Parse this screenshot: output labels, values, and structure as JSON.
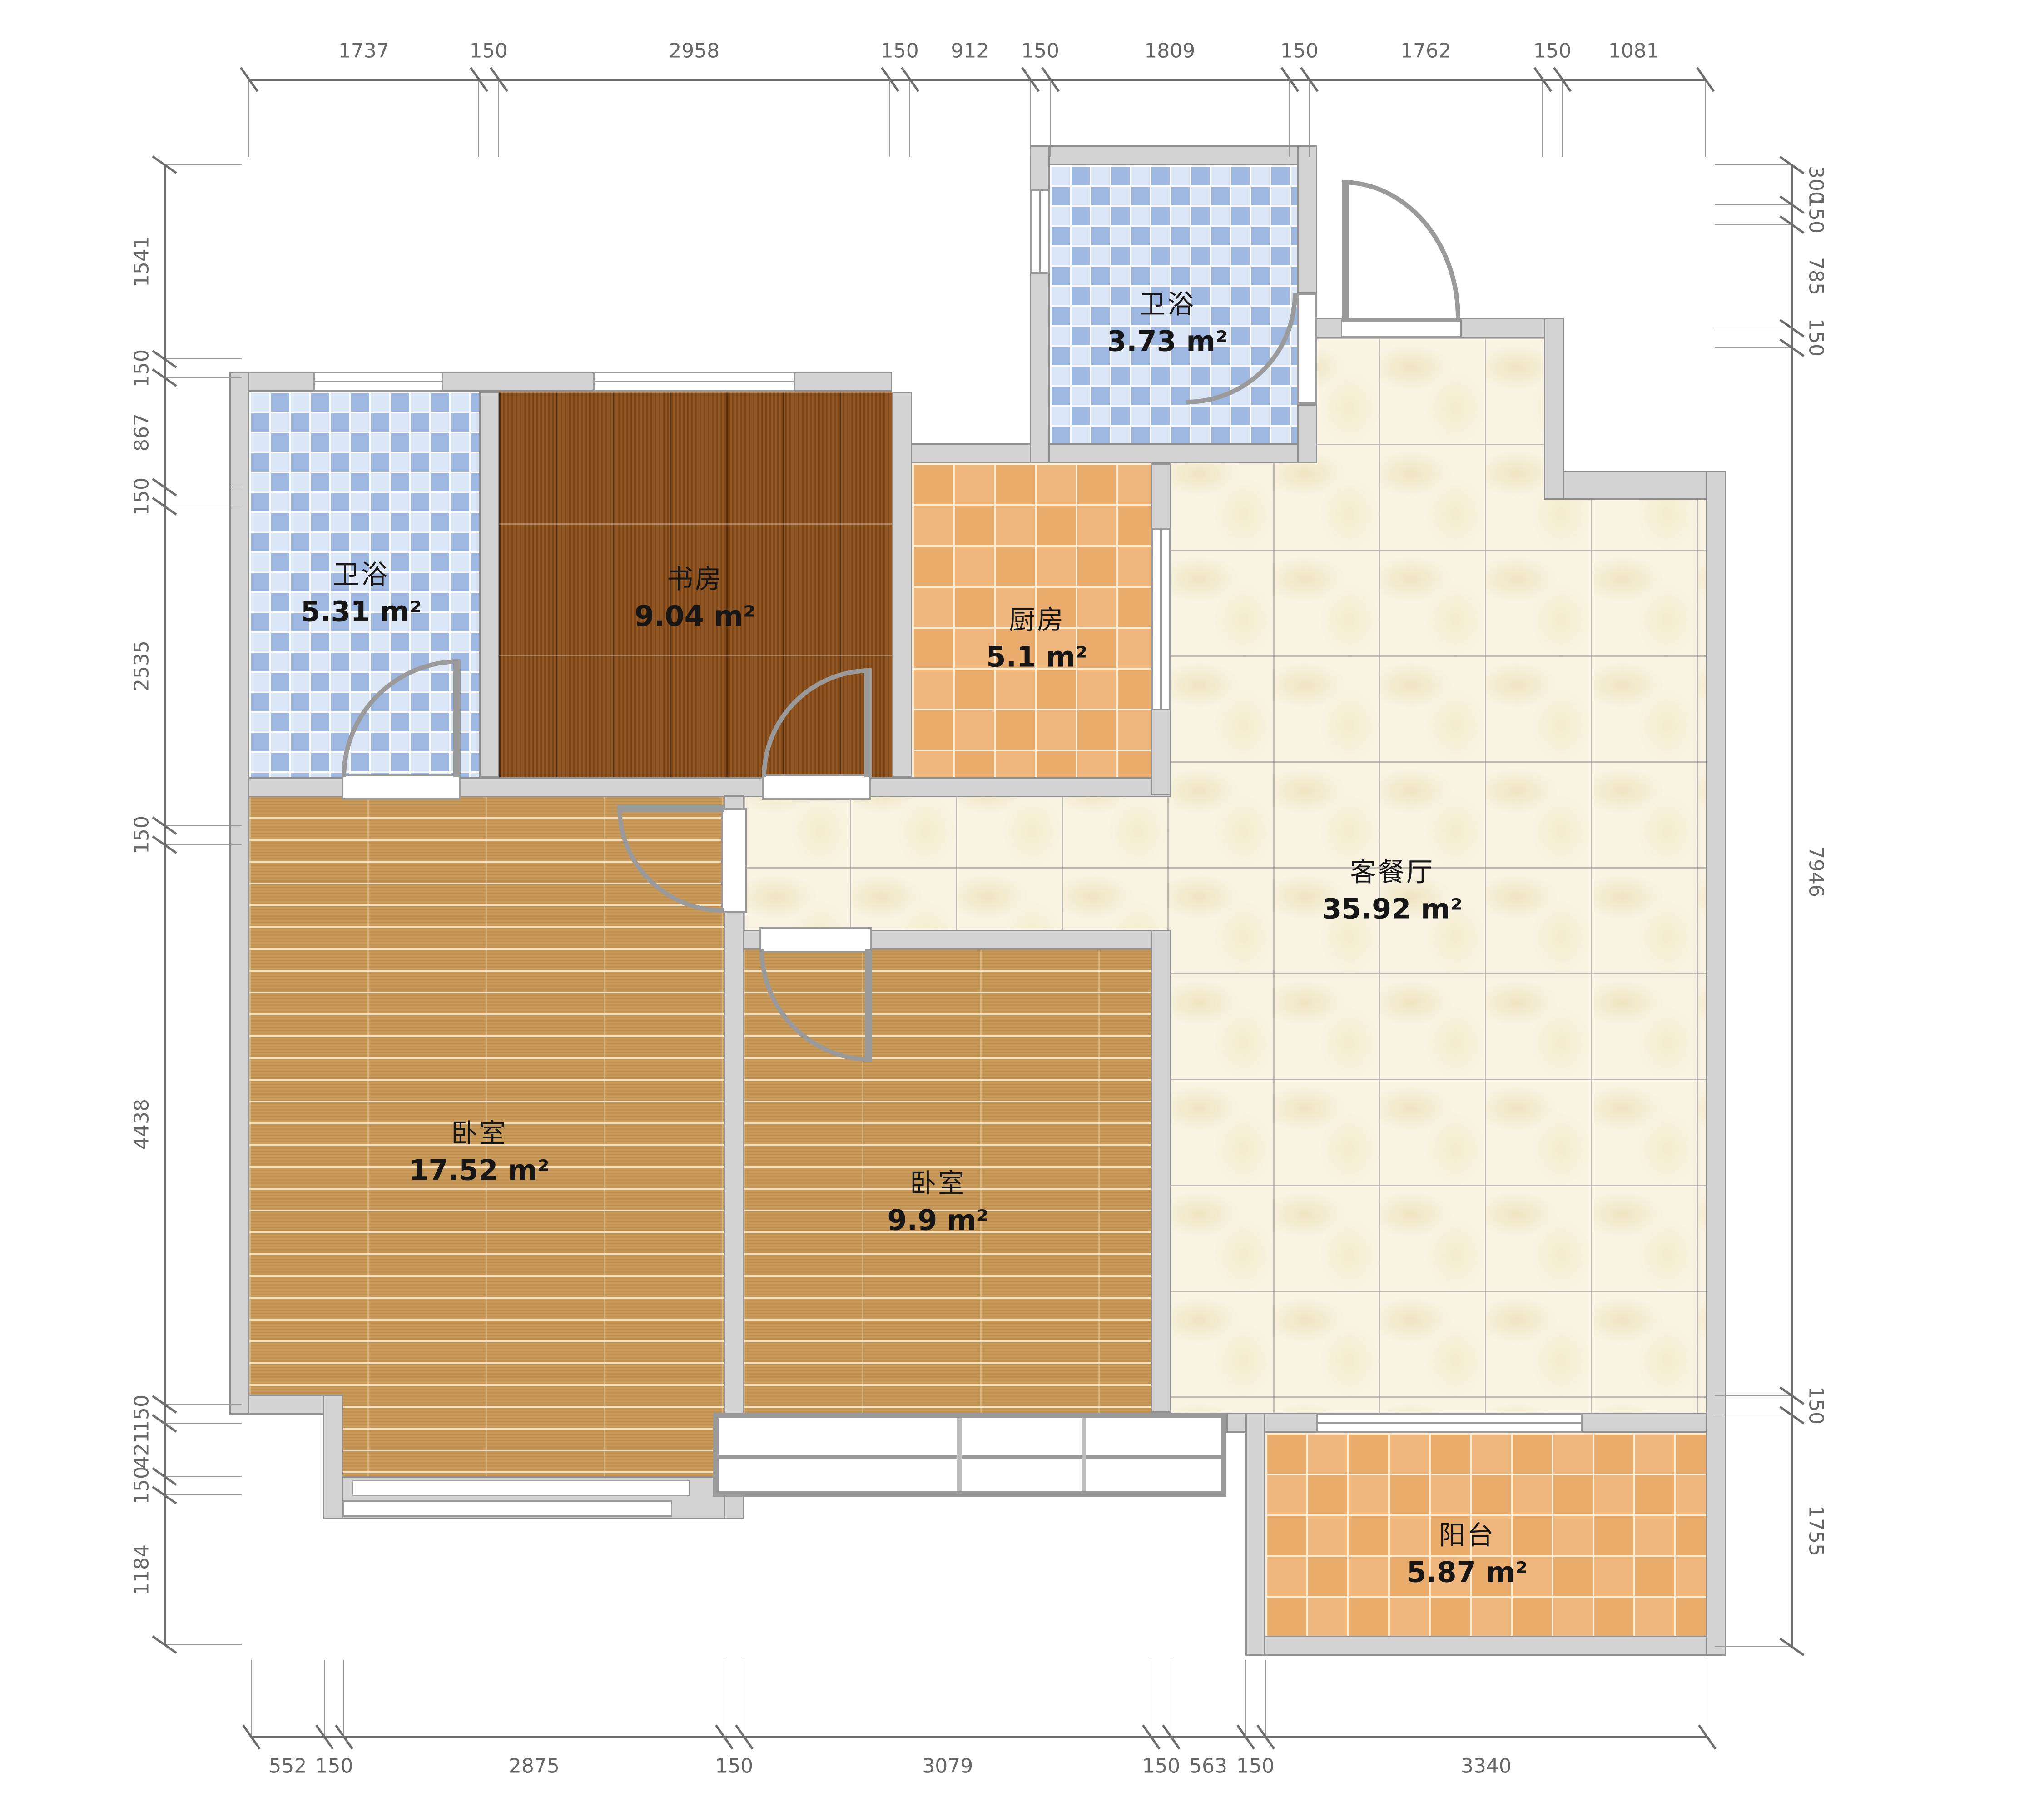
{
  "floorplan": {
    "rooms": [
      {
        "id": "bath-top",
        "name": "卫浴",
        "area": "3.73 m²"
      },
      {
        "id": "bath-left",
        "name": "卫浴",
        "area": "5.31 m²"
      },
      {
        "id": "study",
        "name": "书房",
        "area": "9.04 m²"
      },
      {
        "id": "kitchen",
        "name": "厨房",
        "area": "5.1 m²"
      },
      {
        "id": "living-dining",
        "name": "客餐厅",
        "area": "35.92 m²"
      },
      {
        "id": "bedroom-left",
        "name": "卧室",
        "area": "17.52 m²"
      },
      {
        "id": "bedroom-middle",
        "name": "卧室",
        "area": "9.9 m²"
      },
      {
        "id": "balcony",
        "name": "阳台",
        "area": "5.87 m²"
      }
    ],
    "dimensions_mm": {
      "top": [
        1737,
        150,
        2958,
        150,
        912,
        150,
        1809,
        150,
        1762,
        150,
        1081
      ],
      "bottom": [
        552,
        150,
        2875,
        150,
        3079,
        150,
        563,
        150,
        3340
      ],
      "left": [
        1541,
        150,
        867,
        150,
        2535,
        150,
        4438,
        150,
        421,
        150,
        1184
      ],
      "right": [
        300,
        150,
        785,
        150,
        7946,
        150,
        1755
      ]
    },
    "colors": {
      "wall_fill": "#d3d3d3",
      "wall_edge": "#919191",
      "dimension_text": "#676767",
      "blue_tile": "#bcd0ec",
      "orange_tile": "#eeb173",
      "light_wood": "#c59552",
      "dark_wood": "#8a4e1c",
      "marble": "#f8f3e2",
      "door_arc": "#9a9a9a"
    }
  }
}
